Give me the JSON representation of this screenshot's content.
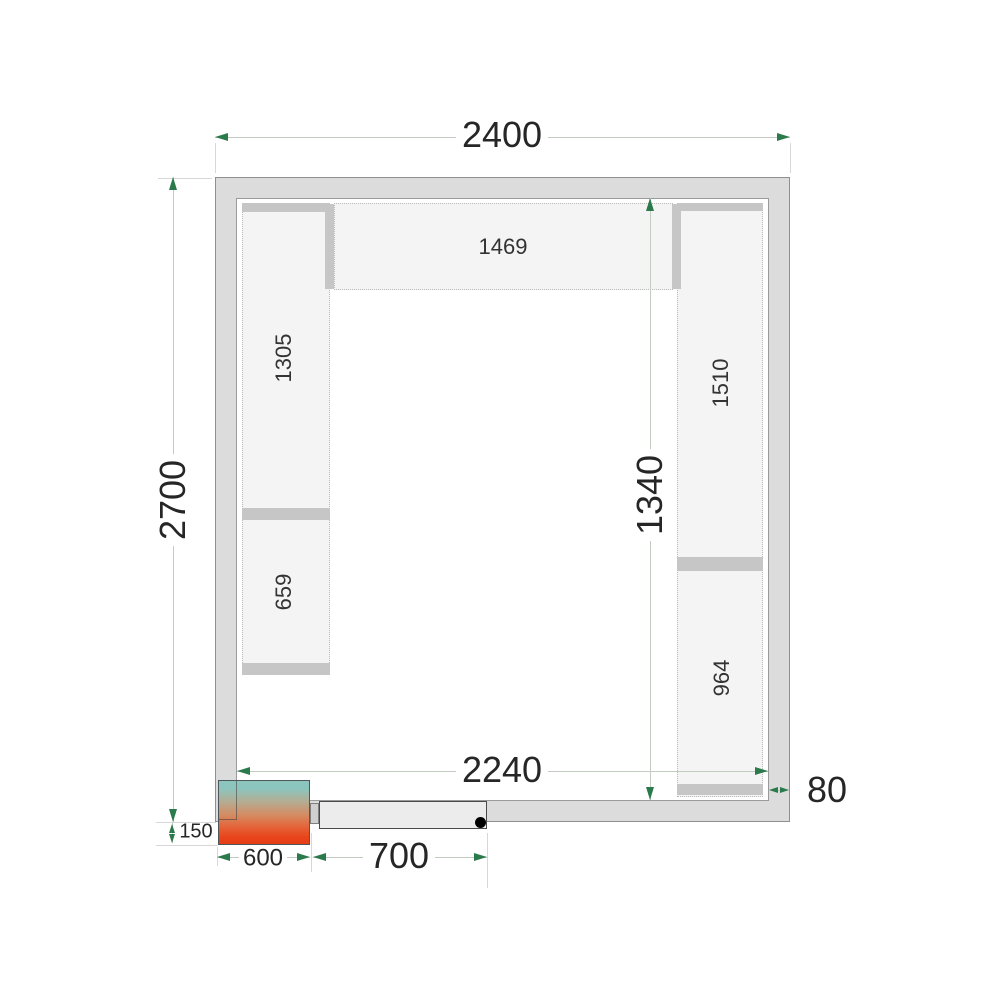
{
  "dimensions": {
    "overall_width": "2400",
    "overall_depth": "2700",
    "interior_width": "2240",
    "interior_span": "1340",
    "wall_thickness": "80",
    "unit_offset": "150",
    "unit_width": "600",
    "door_width": "700"
  },
  "shelves": {
    "top": "1469",
    "left_upper": "1305",
    "left_lower": "659",
    "right_upper": "1510",
    "right_lower": "964"
  },
  "colors": {
    "arrow_green": "#2b7a4c",
    "wall_fill": "#dcdcdc",
    "shelf_fill": "#f4f4f4",
    "shelf_bar": "#c6c6c6",
    "unit_gradient_top": "#8cc5be",
    "unit_gradient_bottom": "#e63c15",
    "dimension_line": "#c3cbc3",
    "text": "#262626"
  }
}
